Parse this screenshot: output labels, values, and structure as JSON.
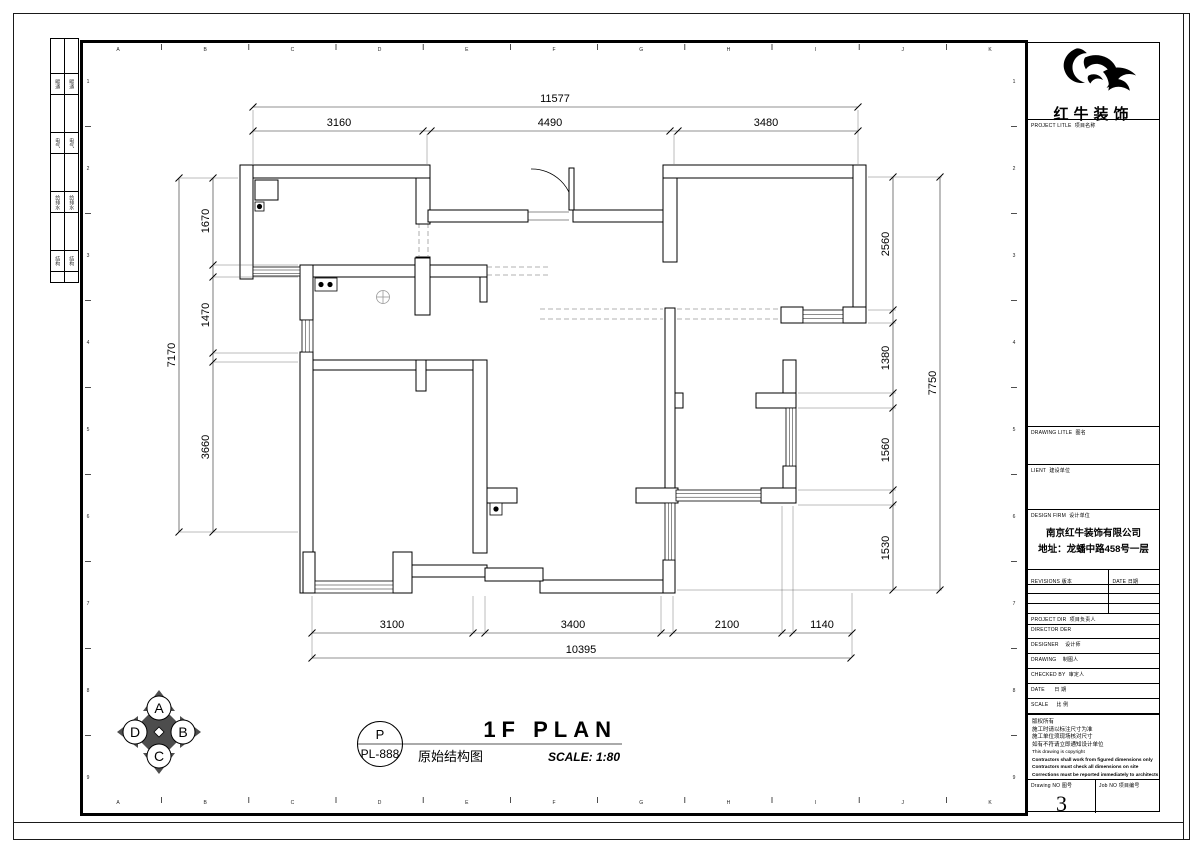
{
  "plan": {
    "title": {
      "main": "1F PLAN",
      "cn": "原始结构图",
      "scale": "SCALE: 1:80"
    },
    "title_ref": {
      "top": "P",
      "code": "PL-888"
    },
    "compass": {
      "top": "A",
      "right": "B",
      "bottom": "C",
      "left": "D"
    },
    "dimensions": {
      "top": {
        "overall": "11577",
        "segments": [
          "3160",
          "4490",
          "3480"
        ]
      },
      "left": {
        "overall": "7170",
        "segments": [
          "1670",
          "1470",
          "3660"
        ]
      },
      "right": {
        "overall": "7750",
        "segments": [
          "2560",
          "1380",
          "1560",
          "1530"
        ]
      },
      "bottom": {
        "overall": "10395",
        "segments": [
          "3100",
          "3400",
          "2100",
          "1140"
        ]
      }
    },
    "grid": {
      "top_letters": [
        "A",
        "B",
        "C",
        "D",
        "E",
        "F",
        "G",
        "H",
        "I",
        "J",
        "K"
      ],
      "side_numbers": [
        "1",
        "2",
        "3",
        "4",
        "5",
        "6",
        "7",
        "8",
        "9"
      ]
    }
  },
  "sign_strip": {
    "rows": [
      {
        "h": 34,
        "label": ""
      },
      {
        "h": 20,
        "label": "暖通"
      },
      {
        "h": 37,
        "label": ""
      },
      {
        "h": 20,
        "label": "电气"
      },
      {
        "h": 37,
        "label": ""
      },
      {
        "h": 20,
        "label": "给排水"
      },
      {
        "h": 37,
        "label": ""
      },
      {
        "h": 20,
        "label": "结构"
      },
      {
        "h": 10,
        "label": ""
      }
    ]
  },
  "title_block": {
    "logo_name": "红牛装饰",
    "project_title": {
      "en": "PROJECT LITLE",
      "cn": "项目名称"
    },
    "drawing_title": {
      "en": "DRAWING LITLE",
      "cn": "图名"
    },
    "client": {
      "en": "LIENT",
      "cn": "建设单位"
    },
    "design_firm": {
      "en": "DESIGN FIRM",
      "cn": "设计单位",
      "company": "南京红牛装饰有限公司",
      "address": "地址：龙蟠中路458号一层"
    },
    "revisions": {
      "en": "REVISIONS",
      "cn": "版本"
    },
    "rev_date": {
      "en": "DATE",
      "cn": "日期"
    },
    "project_dir": {
      "en": "PROJECT DIR",
      "cn": "项目负责人"
    },
    "director": {
      "en": "DIRECTOR DER",
      "cn": ""
    },
    "designer": {
      "en": "DESIGNER",
      "cn": "设计师"
    },
    "drawing_by": {
      "en": "DRAWING",
      "cn": "制图人"
    },
    "checked_by": {
      "en": "CHECKED BY",
      "cn": "审定人"
    },
    "date": {
      "en": "DATE",
      "cn": "日 期"
    },
    "scale": {
      "en": "SCALE",
      "cn": "比 例"
    },
    "notes": [
      "版权所有",
      "施工时请以标注尺寸为准",
      "施工单位须现场核对尺寸",
      "如有不符请立即通知设计单位",
      "This drawing is copyright",
      "Contractors shall work from figured dimensions only",
      "Contractors must check all dimensions on site",
      "Corrections must be reported immediately to architects"
    ],
    "drawing_no": {
      "label": "Drawing NO  图号",
      "value": "3"
    },
    "job_no": {
      "label": "Job NO  项目编号",
      "value": ""
    }
  }
}
